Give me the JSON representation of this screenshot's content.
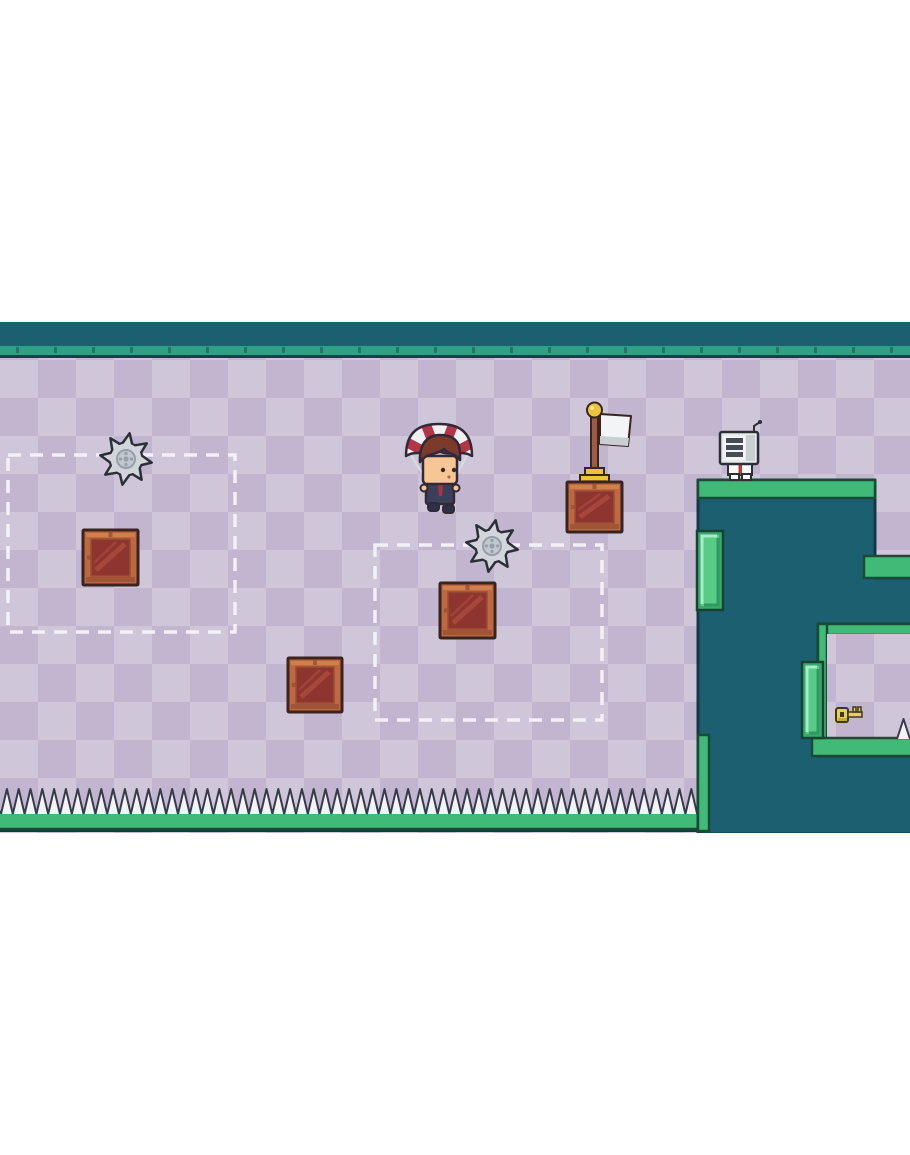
{
  "scene_label": "Pixel platformer level: parachuting character, saw blades, wooden crates, target zones, goal flag, robot enemy, spike floor and a key room",
  "palette": {
    "page_bg": "#ffffff",
    "teal": "#1b5f70",
    "outline_dark": "#123a44",
    "trim": "#2fa084",
    "trim_tick": "#1b6f60",
    "trim_edge": "#11414b",
    "checker_light": "#cfc6da",
    "checker_dark": "#c2b5cf",
    "green": "#40ba76",
    "green_outline": "#1b4a35",
    "green_shade": "#2e9c5e",
    "mint_outer": "#3aa96e",
    "mint_face": "#58cb89",
    "mint_hi": "#a6edc6",
    "mint_shadow": "#2e9a60",
    "mint_outline": "#174430",
    "crate_outline": "#3a2420",
    "crate_frame": "#bd6841",
    "crate_frame_hi": "#d5854e",
    "crate_frame_sh": "#9a4e33",
    "crate_panel": "#8e3530",
    "crate_panel_hi": "#a84a3c",
    "saw_body": "#d2d6dc",
    "saw_hub": "#c3c8cf",
    "saw_hub_dark": "#969ea9",
    "saw_outline": "#2c2f38",
    "spike_fill": "#f3f3f6",
    "spike_outline": "#383b4a",
    "zone_dash": "#f3f0f8",
    "chute_red": "#b23648",
    "chute_white": "#f0f1f3",
    "sprite_outline": "#332837",
    "hair": "#7c3a2a",
    "skin": "#f6c794",
    "suit": "#3a4059",
    "tie": "#b5303c",
    "shoe": "#2c3147",
    "string": "#d8d9de",
    "flag_white": "#f3f4f6",
    "flag_shade": "#c9ced3",
    "pole": "#a05a41",
    "gold": "#ecc43c",
    "gold_dark": "#c79d2a",
    "robot_body": "#e8eaec",
    "robot_screen": "#f4f5f6",
    "robot_bar": "#474d57",
    "robot_shade": "#c9ced3",
    "robot_outline": "#2b2f36",
    "robot_stripe": "#c0392f",
    "key_gold": "#ead04f",
    "key_dark": "#c9a92f",
    "key_outline": "#3f3820"
  },
  "layout": {
    "page_w": 910,
    "page_h": 1155,
    "stage_top": 322,
    "stage_w": 910,
    "stage_h": 511,
    "ceiling_h": 24,
    "trim_y": 24,
    "trim_h": 10,
    "trim_edge_y": 33,
    "trim_edge_h": 3,
    "checker_y": 34,
    "checker_size": 38,
    "floor": {
      "x": 0,
      "y": 490,
      "w": 712,
      "h": 17
    },
    "floor_underline": {
      "x": 0,
      "y": 506,
      "w": 714,
      "h": 4
    },
    "wall_path": "M698,158 H875 V256 H912 V302 H818 V434 H912 V512 H698 Z"
  },
  "entities": {
    "spike_row": {
      "x": 1,
      "base_y": 492,
      "count": 59,
      "w": 11.8,
      "h": 25
    },
    "room_spike": {
      "x": 897,
      "base_y": 417,
      "count": 1,
      "w": 13,
      "h": 20
    },
    "zones": [
      {
        "x": 8,
        "y": 133,
        "w": 227,
        "h": 177
      },
      {
        "x": 375,
        "y": 223,
        "w": 227,
        "h": 175
      }
    ],
    "saws": [
      {
        "cx": 126,
        "cy": 137,
        "r": 26
      },
      {
        "cx": 492,
        "cy": 224,
        "r": 26
      }
    ],
    "crates": [
      {
        "x": 83,
        "y": 208,
        "w": 55,
        "h": 55
      },
      {
        "x": 440,
        "y": 261,
        "w": 55,
        "h": 55
      },
      {
        "x": 288,
        "y": 336,
        "w": 54,
        "h": 54
      }
    ],
    "flag_crate": {
      "x": 567,
      "y": 160,
      "w": 55,
      "h": 50
    },
    "platform_top": {
      "x": 698,
      "y": 158,
      "w": 177,
      "h": 18
    },
    "notch_ledge": {
      "x": 864,
      "y": 234,
      "w": 48,
      "h": 22
    },
    "wall_left_trim": {
      "x": 698,
      "y": 413,
      "w": 11,
      "h": 96
    },
    "room": {
      "ceiling": {
        "x": 818,
        "y": 302,
        "w": 94,
        "h": 11
      },
      "left_trim": {
        "x": 818,
        "y": 302,
        "w": 9,
        "h": 114
      },
      "interior": {
        "x": 827,
        "y": 312,
        "w": 85,
        "h": 104
      },
      "floor": {
        "x": 812,
        "y": 416,
        "w": 100,
        "h": 18
      }
    },
    "mint_ledges": [
      {
        "x": 697,
        "y": 209,
        "w": 26,
        "h": 79
      },
      {
        "x": 802,
        "y": 340,
        "w": 21,
        "h": 76
      }
    ],
    "player": {
      "x": 403,
      "y": 100
    },
    "flag": {
      "x": 562,
      "y": 80
    },
    "robot": {
      "x": 716,
      "y": 98
    },
    "key": {
      "x": 836,
      "y": 382
    }
  }
}
